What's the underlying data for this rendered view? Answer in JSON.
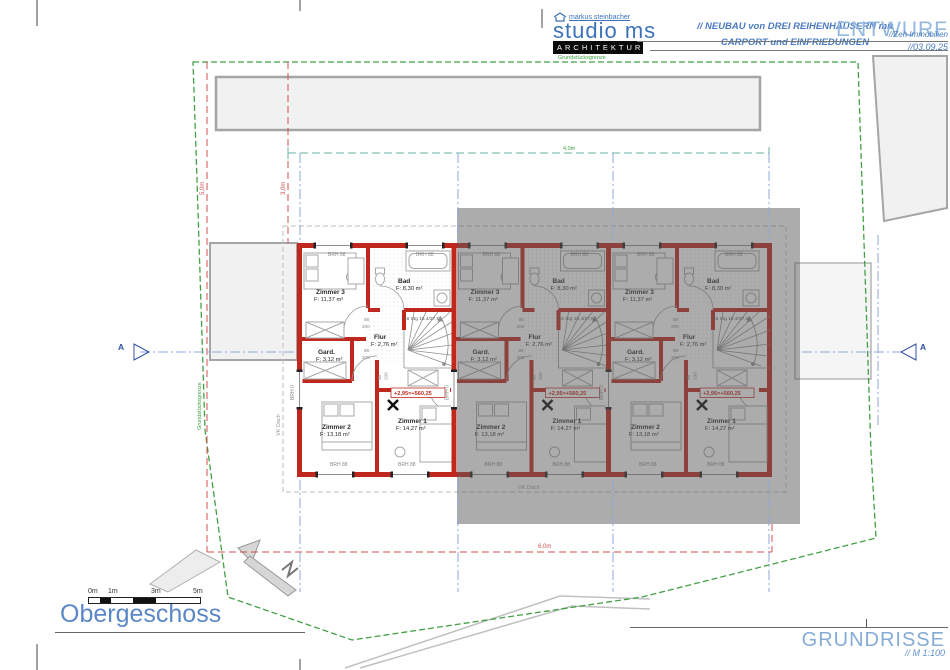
{
  "header": {
    "studio_sub": "markus steinbacher",
    "studio_name": "studio ms",
    "studio_tag": "ARCHITEKTUR",
    "project_line1": "// NEUBAU von DREI REIHENHÄUSERN mit",
    "project_line2": "CARPORT und EINFRIEDUNGEN",
    "status": "ENTWURF",
    "client": "//Zeh Immobilien",
    "date": "//03.09.25"
  },
  "footer": {
    "plan_title": "Obergeschoss",
    "sheet_title": "GRUNDRISSE",
    "scale": "// M 1:100",
    "scalebar_labels": [
      "0m",
      "1m",
      "3m",
      "5m"
    ]
  },
  "site": {
    "boundary_label": "Grundstücksgrenze",
    "dim_top": "4,0m",
    "dim_bottom": "6,0m",
    "dim_left_outer": "5,0m",
    "dim_left_inner": "3,0m",
    "roof_edge_label": "VK Dach",
    "section_label": "A"
  },
  "plan": {
    "rooms": {
      "zimmer3": {
        "name": "Zimmer 3",
        "area": "F: 11,37 m²"
      },
      "bad": {
        "name": "Bad",
        "area": "F: 8,30 m²"
      },
      "flur": {
        "name": "Flur",
        "area": "F: 2,76 m²"
      },
      "gard": {
        "name": "Gard.",
        "area": "F: 3,12 m²"
      },
      "zimmer2": {
        "name": "Zimmer 2",
        "area": "F: 13,18 m²"
      },
      "zimmer1": {
        "name": "Zimmer 1",
        "area": "F: 14,27 m²"
      }
    },
    "stair_note": "16 Stg 18,4/27,6",
    "level_marker": "+2,95=+560,25",
    "window_sill": "BRH 88",
    "window_sill_zero": "BRH 0",
    "door_width": "88",
    "door_height": "200"
  },
  "colors": {
    "accent_blue": "#4a7abf",
    "status_blue": "#93b7e0",
    "wall_red": "#c0281e",
    "boundary_green": "#3fa03f",
    "axis_blue": "#8fa6d8",
    "dim_red": "#d05050",
    "ghost_overlay": "rgba(90,90,90,0.5)"
  }
}
